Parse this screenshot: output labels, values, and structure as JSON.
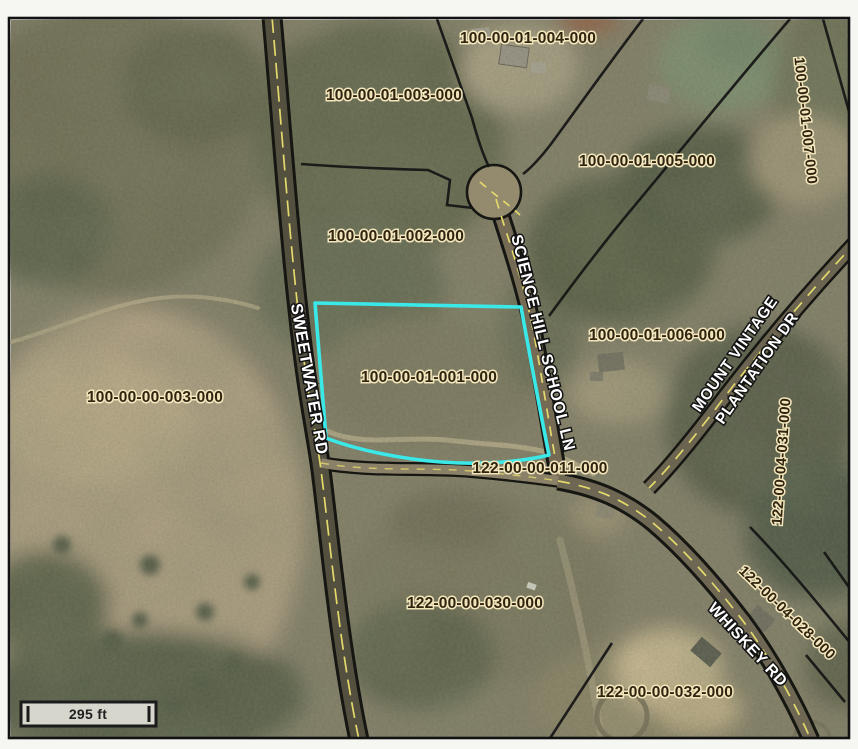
{
  "scale_bar": {
    "label": "295 ft"
  },
  "colors": {
    "highlight": "#3BE8E8",
    "parcel_label_fill": "#2F2410",
    "parcel_label_halo": "#F3E6BC",
    "road_label_fill": "#FFFFFF",
    "road_label_halo": "#131313",
    "centerline_yellow": "#E3D96B",
    "boundary_black": "#151515"
  },
  "highlighted_parcel_id": "100-00-01-001-000",
  "parcels": [
    {
      "id": "100-00-01-004-000"
    },
    {
      "id": "100-00-01-003-000"
    },
    {
      "id": "100-00-01-005-000"
    },
    {
      "id": "100-00-01-007-000"
    },
    {
      "id": "100-00-01-002-000"
    },
    {
      "id": "100-00-01-001-000",
      "highlighted": true
    },
    {
      "id": "100-00-00-003-000"
    },
    {
      "id": "100-00-01-006-000"
    },
    {
      "id": "122-00-04-031-000"
    },
    {
      "id": "122-00-00-011-000"
    },
    {
      "id": "122-00-00-030-000"
    },
    {
      "id": "122-00-04-028-000"
    },
    {
      "id": "122-00-00-032-000"
    }
  ],
  "roads": [
    {
      "name": "SWEETWATER RD"
    },
    {
      "name": "SCIENCE HILL SCHOOL LN"
    },
    {
      "name": "MOUNT VINTAGE PLANTATION DR",
      "line1": "MOUNT VINTAGE",
      "line2": "PLANTATION DR"
    },
    {
      "name": "WHISKEY RD"
    }
  ]
}
